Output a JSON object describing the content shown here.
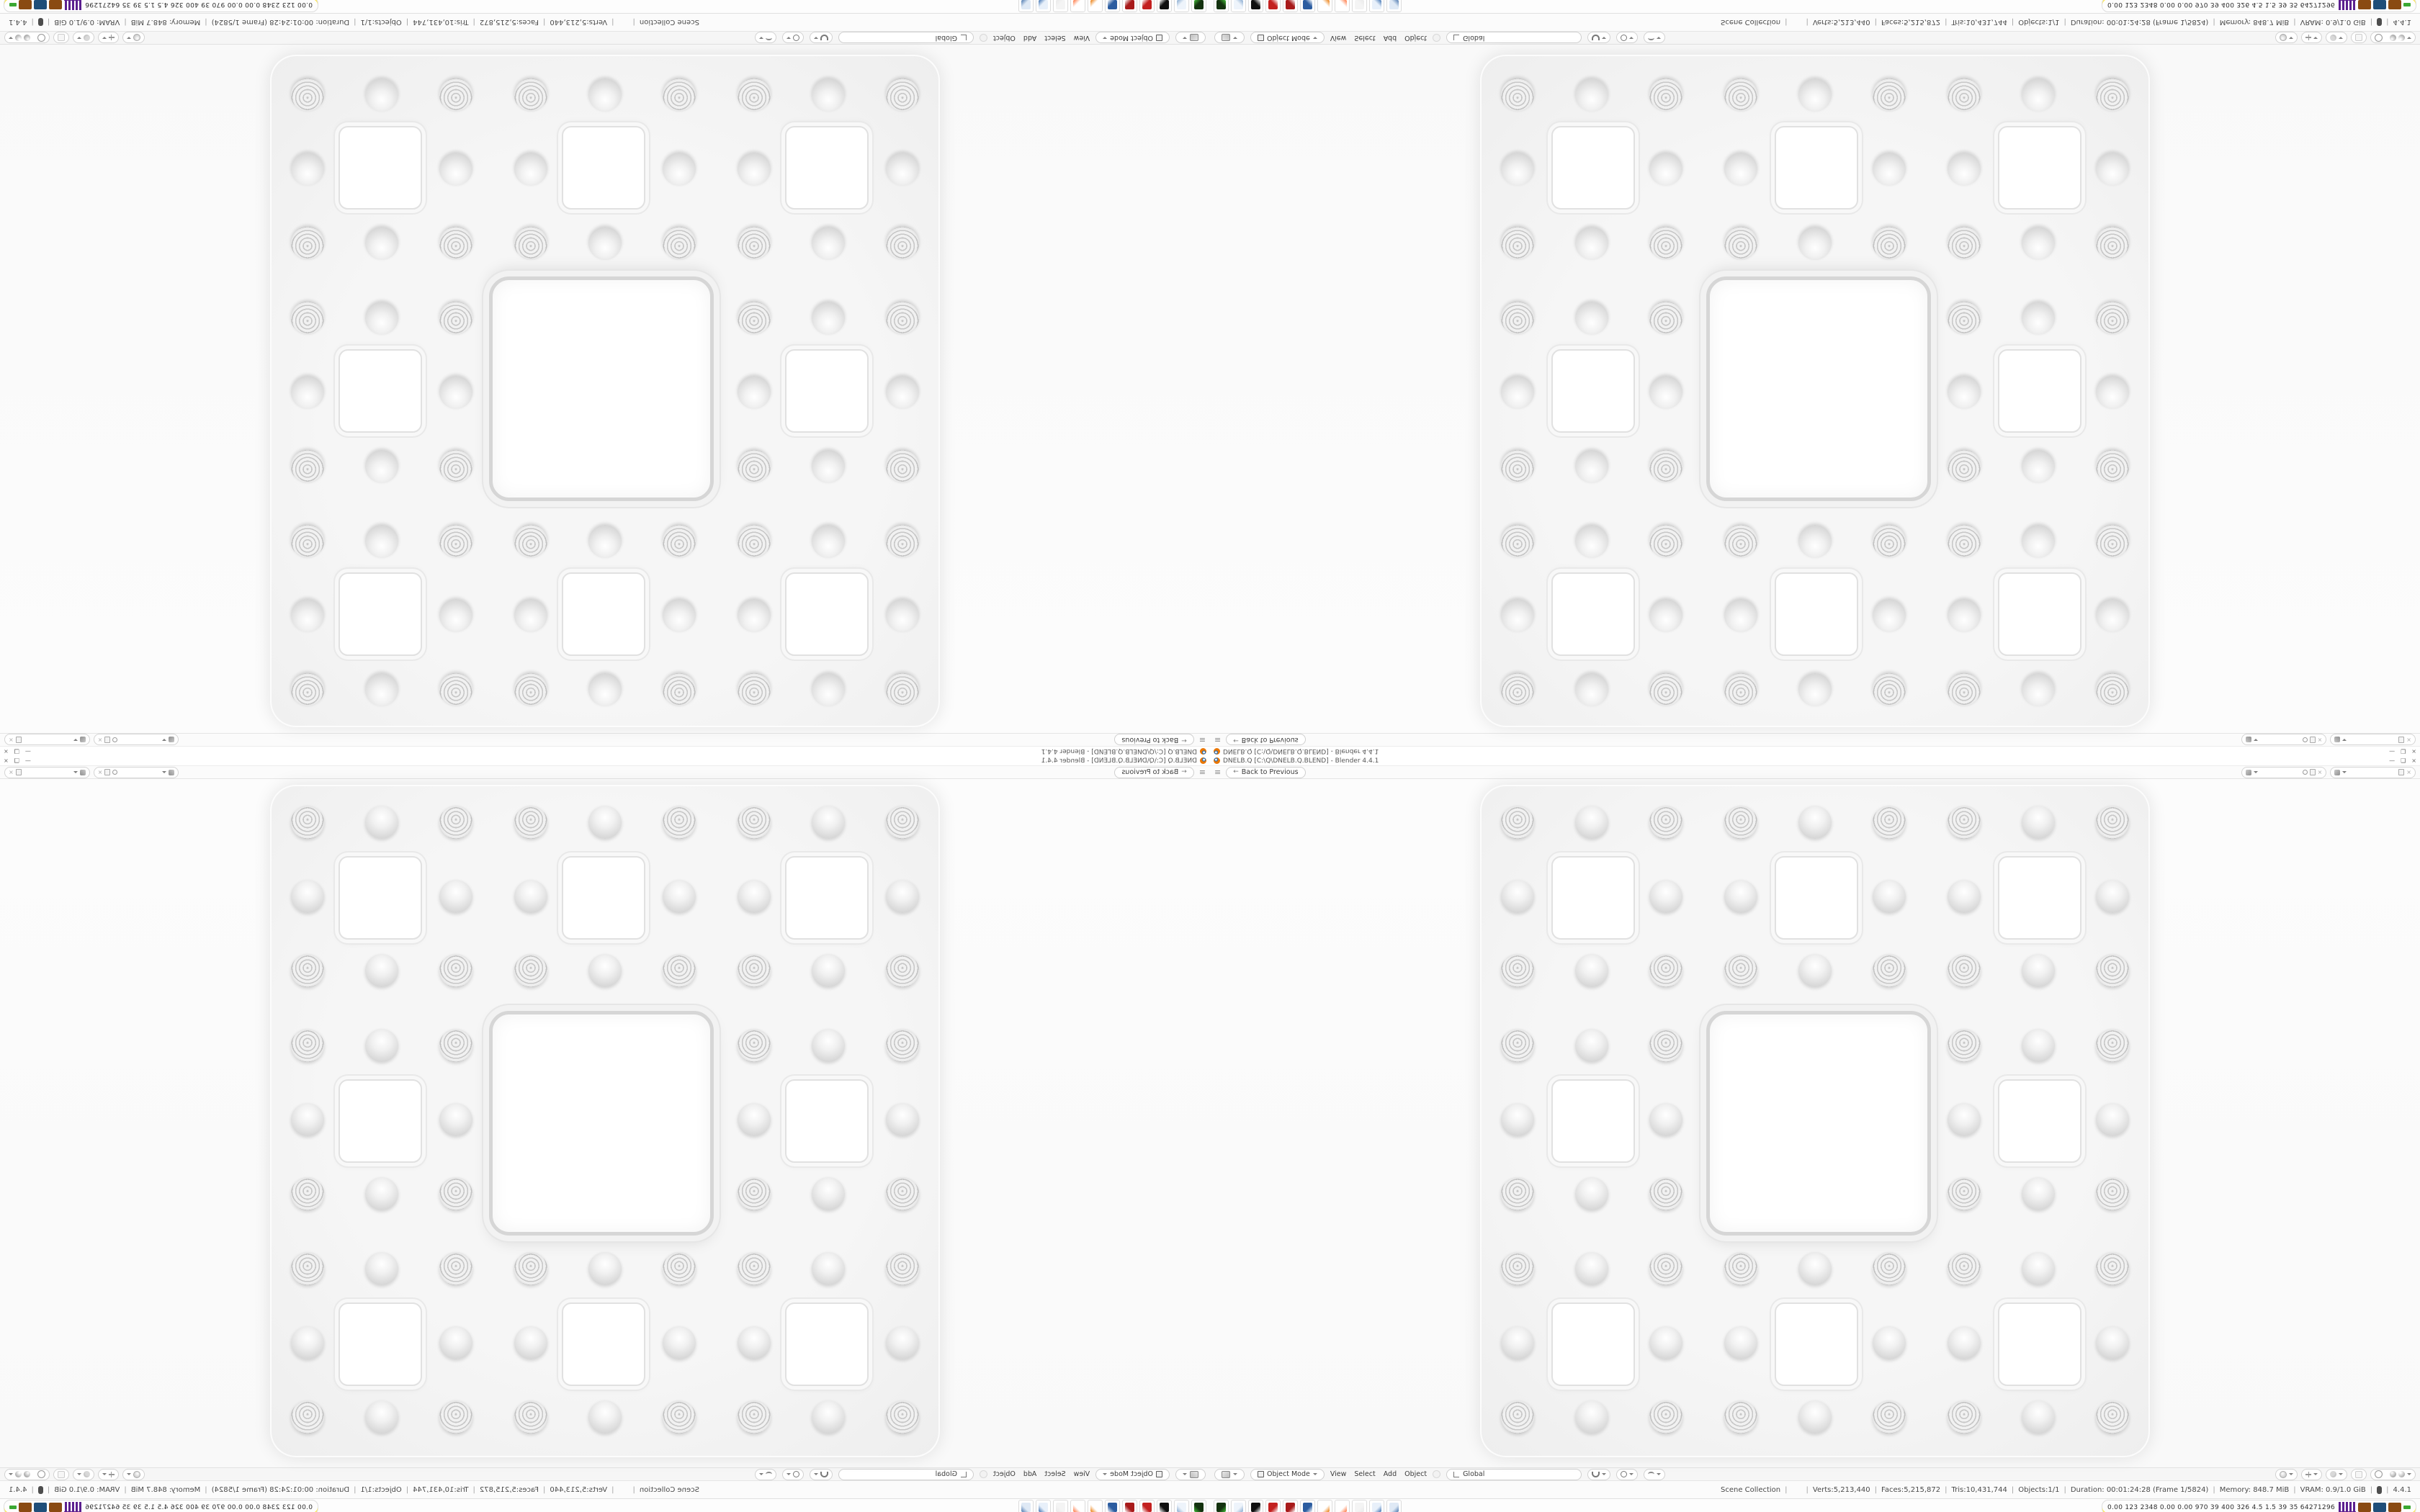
{
  "app": "Blender",
  "window": {
    "title": "DNELB.Q [C:\\Q\\DNELB.Q.BLEND] - Blender 4.4.1",
    "controls": {
      "minimize": "—",
      "maximize": "❑",
      "close": "×"
    }
  },
  "topbar": {
    "menu_icon": "≡",
    "back_arrow": "←",
    "back_button": "Back to Previous"
  },
  "viewport": {
    "sponge": {
      "grid": 9,
      "slab_color": "#f3f3f3",
      "hole_color": "#ffffff",
      "ring_color": "#c7c7c7",
      "shadow_color": "rgba(0,0,0,0.12)"
    }
  },
  "viewport_header": {
    "mode": "Object Mode",
    "menus": [
      "View",
      "Select",
      "Add",
      "Object"
    ],
    "orientation": "Global"
  },
  "statusbar": {
    "scene": "Scene Collection",
    "object_slot": "",
    "separator": "|",
    "stats": [
      "Verts:5,213,440",
      "Faces:5,215,872",
      "Tris:10,431,744",
      "Objects:1/1",
      "Duration: 00:01:24:28 (Frame 1/5824)",
      "Memory: 848.7 MiB",
      "VRAM: 0.9/1.0 GiB"
    ],
    "version": "4.4.1"
  },
  "taskbar": {
    "apps": [
      {
        "name": "system-monitor-app",
        "color": "#14320f",
        "accent": "#45c03a"
      },
      {
        "name": "notepad-app",
        "color": "#eef4fb",
        "accent": "#86a9cf"
      },
      {
        "name": "terminal-app",
        "color": "#101010",
        "accent": "#ffffff"
      },
      {
        "name": "red-grid-app",
        "color": "#c3201f",
        "accent": "#ffffff"
      },
      {
        "name": "red-grid-app-2",
        "color": "#a81a1a",
        "accent": "#ffffff"
      },
      {
        "name": "floppy-disk-app",
        "color": "#2b5ca0",
        "accent": "#ffffff"
      },
      {
        "name": "blender-app",
        "color": "#ffffff",
        "accent": "#ea7600"
      },
      {
        "name": "firefox-app",
        "color": "#ffffff",
        "accent": "#ff7139"
      },
      {
        "name": "ghost-slot",
        "color": "#f4f4f4",
        "accent": "#e9e9e9"
      },
      {
        "name": "pc-app",
        "color": "#e8f0fa",
        "accent": "#3a6fb0"
      },
      {
        "name": "calculator-app",
        "color": "#dfe9f5",
        "accent": "#4a76ad"
      }
    ],
    "tray_numbers": "0.00 123 2348 0.00 0.00 970 39 400 326 4.5 1.5 39 35 64271296",
    "tray_icons": [
      {
        "name": "castle-widget-icon",
        "color": "#5b1f8f",
        "shape": "castle"
      },
      {
        "name": "brown-tray-icon",
        "color": "#8a4a12",
        "shape": "block"
      },
      {
        "name": "blue-tray-icon",
        "color": "#1f4e79",
        "shape": "block"
      },
      {
        "name": "brown-tray-icon-2",
        "color": "#8a4a12",
        "shape": "block"
      },
      {
        "name": "green-tray-icon",
        "color": "#3aa832",
        "shape": "sliver"
      }
    ],
    "accent_underline": "#ffe94a"
  },
  "quadrants": [
    {
      "id": "top-left",
      "transform": "rotate-180"
    },
    {
      "id": "top-right",
      "transform": "flip-vertical"
    },
    {
      "id": "bottom-left",
      "transform": "flip-horizontal"
    },
    {
      "id": "bottom-right",
      "transform": "none"
    }
  ]
}
